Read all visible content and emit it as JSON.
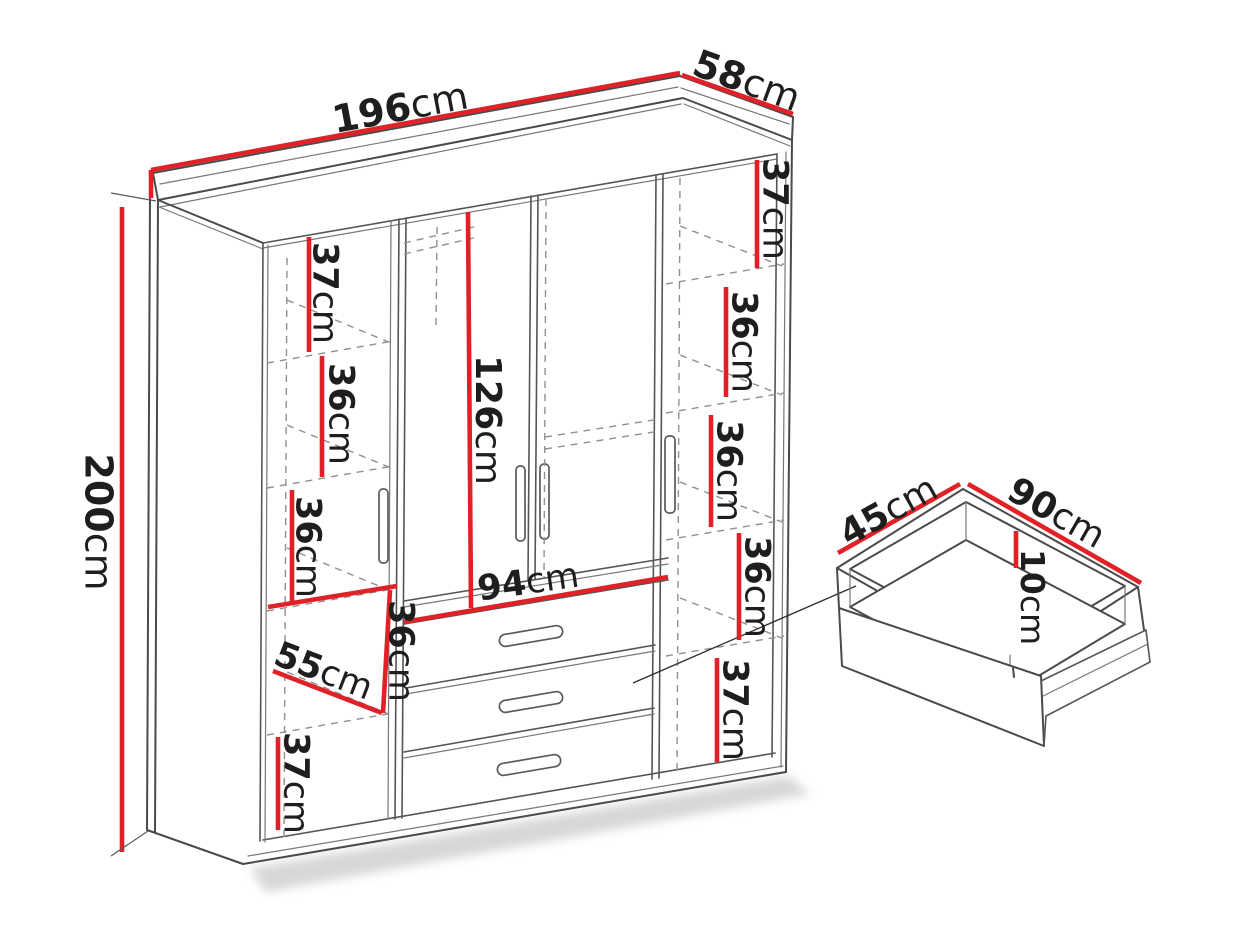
{
  "diagram_type": "furniture-dimension-diagram",
  "colors": {
    "dimension_red": "#e02127",
    "line_gray": "#4a4a4a",
    "dash_gray": "#909090",
    "text": "#1e1e1e",
    "background": "#ffffff"
  },
  "wardrobe": {
    "width": {
      "value": "196",
      "unit": "cm"
    },
    "depth": {
      "value": "58",
      "unit": "cm"
    },
    "height": {
      "value": "200",
      "unit": "cm"
    },
    "left_column": [
      {
        "value": "37",
        "unit": "cm"
      },
      {
        "value": "36",
        "unit": "cm"
      },
      {
        "value": "36",
        "unit": "cm"
      },
      {
        "value": "55",
        "unit": "cm"
      },
      {
        "value": "36",
        "unit": "cm"
      },
      {
        "value": "37",
        "unit": "cm"
      }
    ],
    "middle_column": {
      "hanging_height": {
        "value": "126",
        "unit": "cm"
      },
      "drawer_width": {
        "value": "94",
        "unit": "cm"
      }
    },
    "right_column": [
      {
        "value": "37",
        "unit": "cm"
      },
      {
        "value": "36",
        "unit": "cm"
      },
      {
        "value": "36",
        "unit": "cm"
      },
      {
        "value": "36",
        "unit": "cm"
      },
      {
        "value": "37",
        "unit": "cm"
      }
    ]
  },
  "drawer_detail": {
    "depth": {
      "value": "45",
      "unit": "cm"
    },
    "width": {
      "value": "90",
      "unit": "cm"
    },
    "height": {
      "value": "10",
      "unit": "cm"
    }
  }
}
